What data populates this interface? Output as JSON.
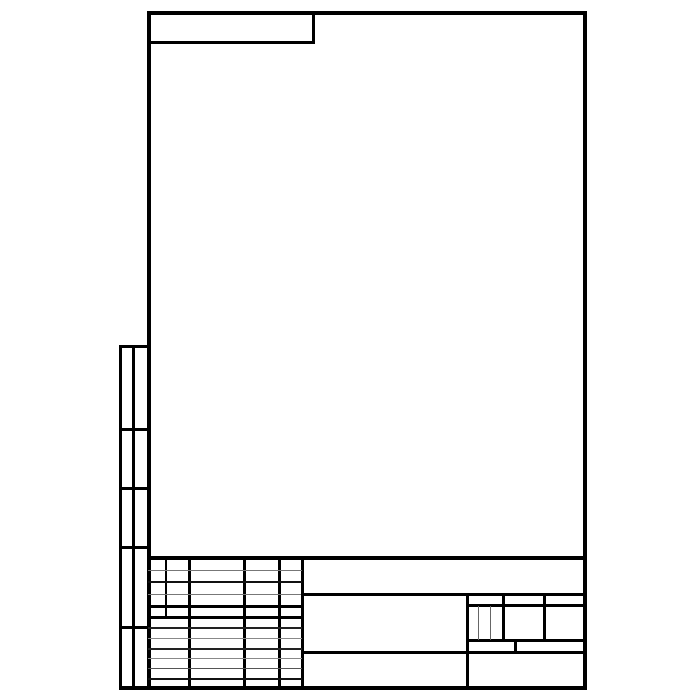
{
  "sheet": {
    "width": 700,
    "height": 700,
    "background_color": "#ffffff",
    "line_color": "#000000",
    "thin_line_color": "#777777"
  },
  "groups": [
    {
      "name": "main-frame",
      "lines": [
        {
          "name": "frame-top-edge",
          "x": 147,
          "y": 11,
          "w": 440,
          "h": 4,
          "color": "#000000"
        },
        {
          "name": "frame-bottom-edge",
          "x": 119,
          "y": 686,
          "w": 468,
          "h": 4,
          "color": "#000000"
        },
        {
          "name": "frame-left-edge",
          "x": 147,
          "y": 11,
          "w": 4,
          "h": 679,
          "color": "#000000"
        },
        {
          "name": "frame-right-edge",
          "x": 583,
          "y": 11,
          "w": 4,
          "h": 679,
          "color": "#000000"
        }
      ]
    },
    {
      "name": "corner-designation-block",
      "lines": [
        {
          "name": "corner-block-bottom-line",
          "x": 147,
          "y": 41,
          "w": 168,
          "h": 3,
          "color": "#000000"
        },
        {
          "name": "corner-block-right-line",
          "x": 312,
          "y": 11,
          "w": 3,
          "h": 33,
          "color": "#000000"
        }
      ]
    },
    {
      "name": "left-attachment-column",
      "lines": [
        {
          "name": "attachment-column-left-line",
          "x": 119,
          "y": 345,
          "w": 3,
          "h": 341,
          "color": "#000000"
        },
        {
          "name": "attachment-column-middle-line",
          "x": 132,
          "y": 345,
          "w": 3,
          "h": 341,
          "color": "#000000"
        },
        {
          "name": "attachment-column-top-line",
          "x": 119,
          "y": 345,
          "w": 32,
          "h": 3,
          "color": "#000000"
        },
        {
          "name": "attachment-column-divider-1",
          "x": 119,
          "y": 428,
          "w": 32,
          "h": 3,
          "color": "#000000"
        },
        {
          "name": "attachment-column-divider-2",
          "x": 119,
          "y": 487,
          "w": 32,
          "h": 3,
          "color": "#000000"
        },
        {
          "name": "attachment-column-divider-3",
          "x": 119,
          "y": 546,
          "w": 32,
          "h": 3,
          "color": "#000000"
        },
        {
          "name": "attachment-column-divider-4",
          "x": 119,
          "y": 626,
          "w": 32,
          "h": 3,
          "color": "#000000"
        }
      ]
    },
    {
      "name": "title-block",
      "lines": [
        {
          "name": "title-block-top-line",
          "x": 147,
          "y": 556,
          "w": 440,
          "h": 4,
          "color": "#000000"
        },
        {
          "name": "approval-table-col-line-1",
          "x": 165,
          "y": 558,
          "w": 2,
          "h": 59,
          "color": "#000000"
        },
        {
          "name": "approval-table-col-line-2",
          "x": 188,
          "y": 558,
          "w": 3,
          "h": 128,
          "color": "#000000"
        },
        {
          "name": "approval-table-col-line-3",
          "x": 243,
          "y": 558,
          "w": 3,
          "h": 128,
          "color": "#000000"
        },
        {
          "name": "approval-table-col-line-4",
          "x": 278,
          "y": 558,
          "w": 3,
          "h": 128,
          "color": "#000000"
        },
        {
          "name": "approval-table-right-line",
          "x": 301,
          "y": 558,
          "w": 3,
          "h": 128,
          "color": "#000000"
        },
        {
          "name": "approval-table-row-line-1",
          "x": 148,
          "y": 570,
          "w": 154,
          "h": 1,
          "color": "#777777"
        },
        {
          "name": "approval-table-row-line-2",
          "x": 148,
          "y": 581,
          "w": 154,
          "h": 2,
          "color": "#111111"
        },
        {
          "name": "approval-table-row-line-3",
          "x": 148,
          "y": 594,
          "w": 154,
          "h": 1,
          "color": "#777777"
        },
        {
          "name": "approval-table-row-line-4",
          "x": 148,
          "y": 605,
          "w": 154,
          "h": 3,
          "color": "#000000"
        },
        {
          "name": "approval-table-row-line-5",
          "x": 148,
          "y": 616,
          "w": 154,
          "h": 3,
          "color": "#000000"
        },
        {
          "name": "signature-table-row-line-1",
          "x": 148,
          "y": 627,
          "w": 154,
          "h": 2,
          "color": "#222222"
        },
        {
          "name": "signature-table-row-line-2",
          "x": 148,
          "y": 638,
          "w": 154,
          "h": 1,
          "color": "#888888"
        },
        {
          "name": "signature-table-row-line-3",
          "x": 148,
          "y": 648,
          "w": 154,
          "h": 2,
          "color": "#222222"
        },
        {
          "name": "signature-table-row-line-4",
          "x": 148,
          "y": 658,
          "w": 154,
          "h": 1,
          "color": "#888888"
        },
        {
          "name": "signature-table-row-line-5",
          "x": 148,
          "y": 668,
          "w": 154,
          "h": 1,
          "color": "#555555"
        },
        {
          "name": "signature-table-row-line-6",
          "x": 148,
          "y": 678,
          "w": 154,
          "h": 2,
          "color": "#111111"
        },
        {
          "name": "designation-cell-bottom-line",
          "x": 301,
          "y": 593,
          "w": 286,
          "h": 3,
          "color": "#000000"
        },
        {
          "name": "scale-header-bottom-line",
          "x": 466,
          "y": 604,
          "w": 121,
          "h": 3,
          "color": "#000000"
        },
        {
          "name": "sheet-row-top-line",
          "x": 466,
          "y": 639,
          "w": 121,
          "h": 3,
          "color": "#000000"
        },
        {
          "name": "organization-cell-top-line",
          "x": 301,
          "y": 651,
          "w": 286,
          "h": 3,
          "color": "#000000"
        },
        {
          "name": "name-cell-right-line",
          "x": 466,
          "y": 594,
          "w": 3,
          "h": 92,
          "color": "#000000"
        },
        {
          "name": "mass-cell-left-line",
          "x": 502,
          "y": 594,
          "w": 3,
          "h": 47,
          "color": "#000000"
        },
        {
          "name": "scale-cell-left-line",
          "x": 543,
          "y": 594,
          "w": 3,
          "h": 47,
          "color": "#000000"
        },
        {
          "name": "lit-cell-divider-1",
          "x": 478,
          "y": 606,
          "w": 1,
          "h": 34,
          "color": "#666666"
        },
        {
          "name": "lit-cell-divider-2",
          "x": 490,
          "y": 606,
          "w": 1,
          "h": 34,
          "color": "#666666"
        },
        {
          "name": "sheet-count-divider-line",
          "x": 514,
          "y": 639,
          "w": 3,
          "h": 15,
          "color": "#000000"
        }
      ]
    }
  ]
}
